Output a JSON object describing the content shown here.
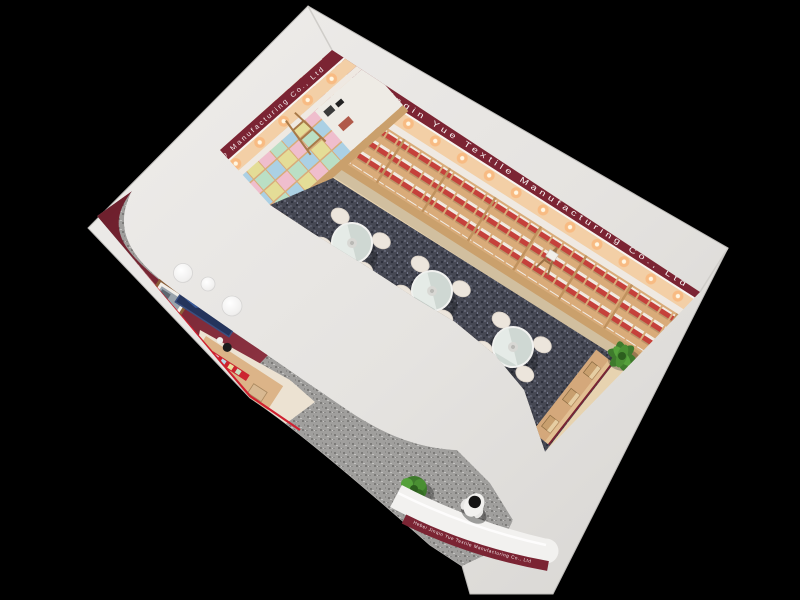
{
  "scene": {
    "type": "3d-interior-render",
    "description": "Bird's-eye cutaway 3D rendering of a textile company showroom with product shelving, a fabric swatch wall, round seating tables and a reception entry area",
    "company_banner": {
      "text": "Hebei Jinqin Yue Textile Manufacturing Co., Ltd"
    },
    "counter_stripe_text": "Hebei Jinqin Yue Textile Manufacturing Co., Ltd",
    "palette": {
      "background": "#000000",
      "roof_white": "#e7e5e2",
      "banner_maroon": "#7b2433",
      "exterior_wall_maroon": "#742331",
      "product_box_red": "#c5413b",
      "shelf_wood": "#d9ab79",
      "cove_glow": "#f3cfa6",
      "carpet_dark": "#464853",
      "walkway_gray": "#a09f9d",
      "chair_cream": "#ece5dc",
      "sign_blue": "#24345c",
      "plant_green": "#3e7a2c",
      "cut_edge_red": "#cf1f2f"
    },
    "fabric_wall_tiles": [
      "#abd0e4",
      "#e4dd97",
      "#efbecd",
      "#badfc5"
    ],
    "inventory": {
      "seating_tables": 3,
      "chairs_per_table": 4,
      "pendant_lights": 3,
      "potted_plants": 2,
      "visitors": 1,
      "bench_display_boxes": 3
    }
  }
}
